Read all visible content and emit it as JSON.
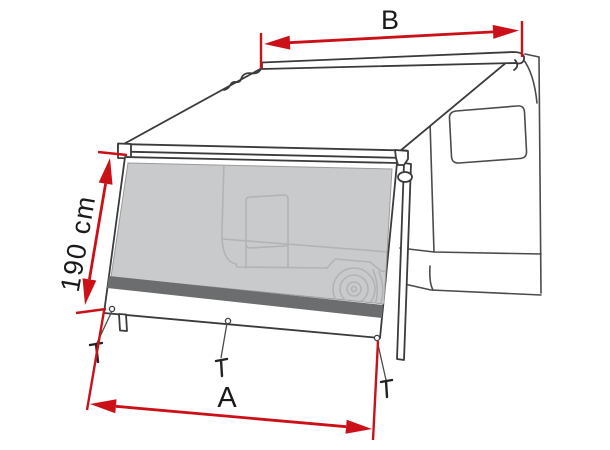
{
  "diagram": {
    "description": "Awning sun-blocker front panel dimension diagram on camper van",
    "canvas": {
      "width": 610,
      "height": 450
    },
    "dimensions": {
      "top_width": {
        "label": "B"
      },
      "side_height": {
        "label": "190 cm"
      },
      "bottom_width": {
        "label": "A"
      }
    },
    "colors": {
      "dimension_red": "#cb1117",
      "outline": "#3b3b3d",
      "van_line": "#4b4b4d",
      "silhouette_line": "#b2b3b5",
      "mesh_fill": "#c9cacc",
      "mesh_edge": "#9a9b9d",
      "band_fill": "#6b6d6e",
      "peg_color": "#232325",
      "label_text": "#1a1a1a",
      "background": "#ffffff"
    }
  }
}
